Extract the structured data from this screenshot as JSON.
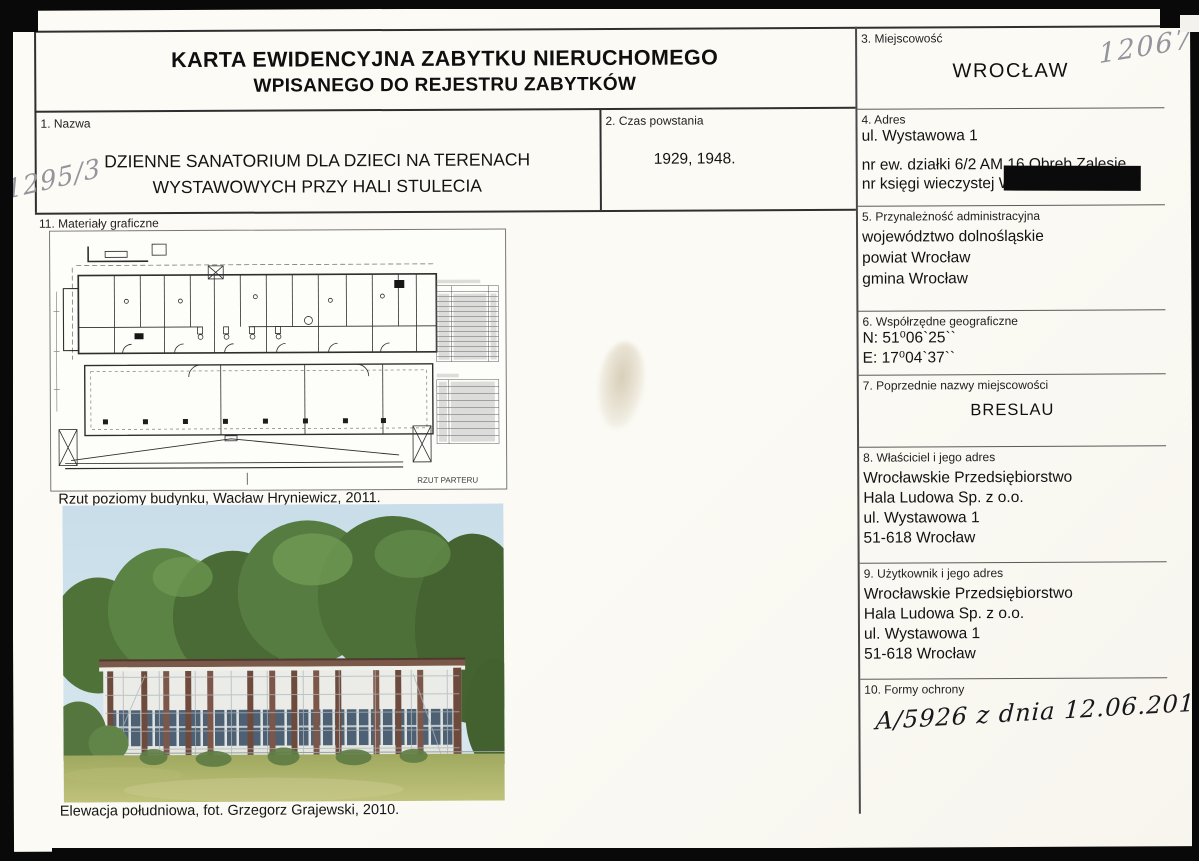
{
  "header": {
    "title_line1": "KARTA EWIDENCYJNA ZABYTKU NIERUCHOMEGO",
    "title_line2": "WPISANEGO DO REJESTRU ZABYTKÓW"
  },
  "annotations": {
    "top_right_number": "12067",
    "left_margin_number": "1295/3"
  },
  "fields": {
    "nazwa": {
      "label": "1. Nazwa",
      "lines": [
        "DZIENNE SANATORIUM DLA DZIECI NA TERENACH",
        "WYSTAWOWYCH PRZY HALI STULECIA"
      ]
    },
    "czas_powstania": {
      "label": "2. Czas powstania",
      "value": "1929, 1948."
    },
    "miejscowosc": {
      "label": "3. Miejscowość",
      "value": "WROCŁAW"
    },
    "adres": {
      "label": "4. Adres",
      "lines": [
        "ul. Wystawowa 1",
        "nr ew. działki 6/2 AM 16 Obręb Zalesie",
        "nr księgi wieczystej W"
      ]
    },
    "przynaleznosc": {
      "label": "5. Przynależność administracyjna",
      "lines": [
        "województwo dolnośląskie",
        "powiat Wrocław",
        "gmina Wrocław"
      ]
    },
    "wspolrzedne": {
      "label": "6. Współrzędne geograficzne",
      "lines": [
        "N: 51⁰06`25``",
        "E: 17⁰04`37``"
      ]
    },
    "poprzednie_nazwy": {
      "label": "7. Poprzednie nazwy miejscowości",
      "value": "BRESLAU"
    },
    "wlasciciel": {
      "label": "8. Właściciel i jego adres",
      "lines": [
        "Wrocławskie Przedsiębiorstwo",
        "Hala Ludowa Sp. z o.o.",
        "ul. Wystawowa 1",
        "51-618 Wrocław"
      ]
    },
    "uzytkownik": {
      "label": "9. Użytkownik i jego adres",
      "lines": [
        "Wrocławskie Przedsiębiorstwo",
        "Hala Ludowa Sp. z o.o.",
        "ul. Wystawowa 1",
        "51-618 Wrocław"
      ]
    },
    "formy_ochrony": {
      "label": "10. Formy ochrony",
      "value": "A/5926 z dnia 12.06.2014 r."
    },
    "materialy": {
      "label": "11. Materiały graficzne"
    }
  },
  "graphics": {
    "plan_label": "RZUT PARTERU",
    "plan_caption": "Rzut poziomy budynku, Wacław Hryniewicz, 2011.",
    "photo_caption": "Elewacja południowa, fot. Grzegorz Grajewski, 2010."
  },
  "colors": {
    "scan_background": "#090909",
    "page_background": "#fbfaf5",
    "ink": "#17171c",
    "pencil": "#94949c",
    "redaction": "#0b0b0b"
  }
}
